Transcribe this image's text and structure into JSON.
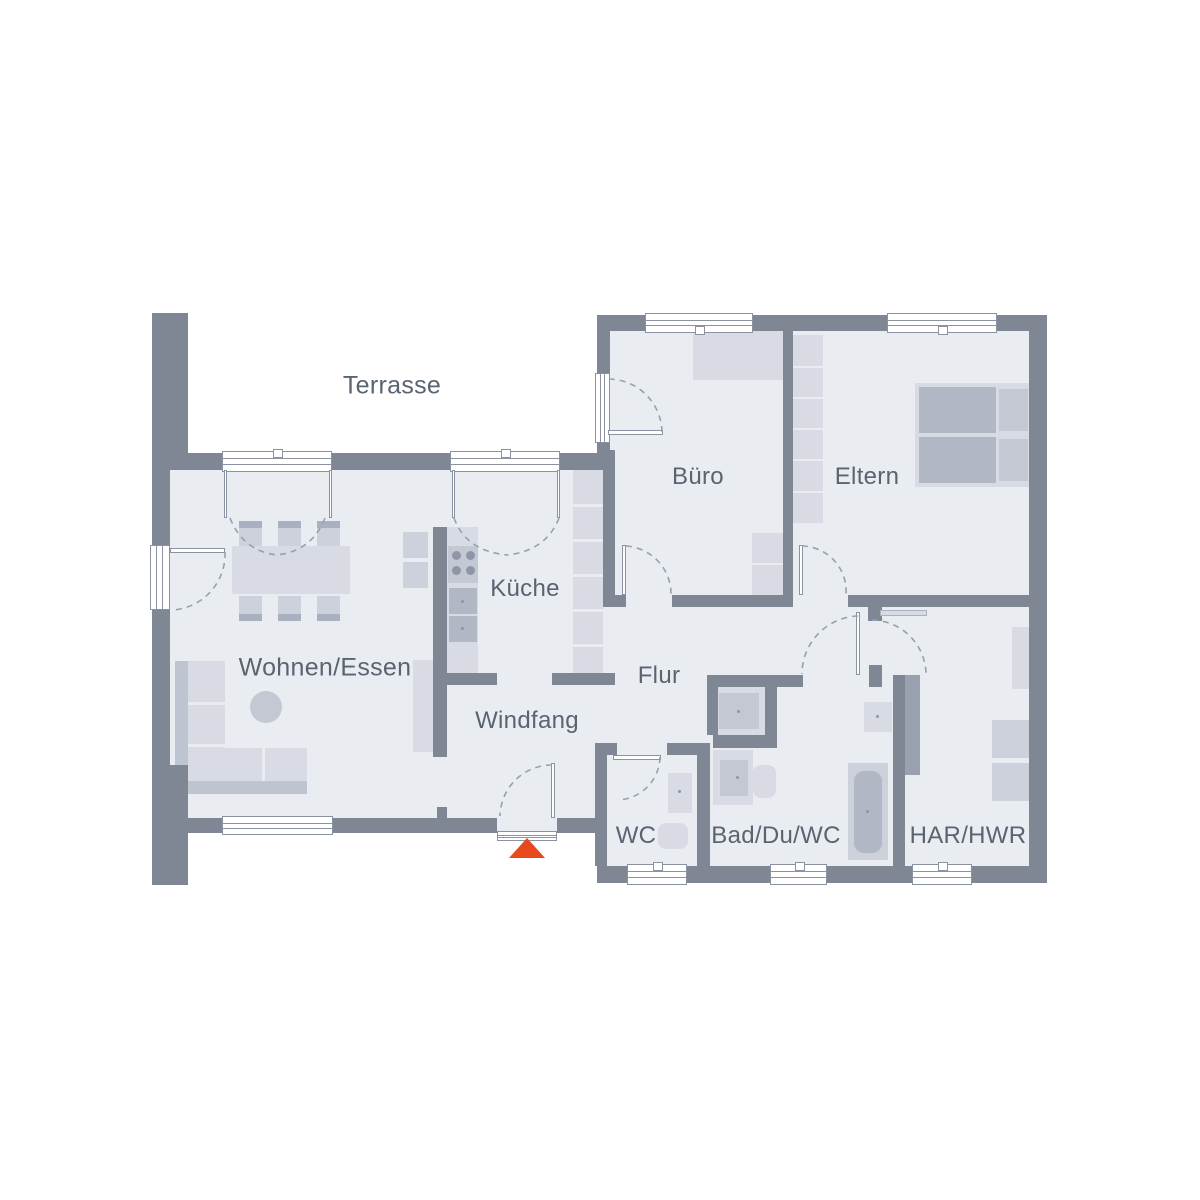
{
  "rooms": {
    "terrasse": "Terrasse",
    "wohnen_essen": "Wohnen/Essen",
    "kueche": "Küche",
    "windfang": "Windfang",
    "flur": "Flur",
    "buero": "Büro",
    "eltern": "Eltern",
    "wc": "WC",
    "bad": "Bad/Du/WC",
    "har_hwr": "HAR/HWR"
  },
  "colors": {
    "wall": "#7f8795",
    "floor": "#e9edf2",
    "entrance_marker": "#e8491c"
  },
  "entrance_marker": {
    "icon": "triangle-up"
  }
}
